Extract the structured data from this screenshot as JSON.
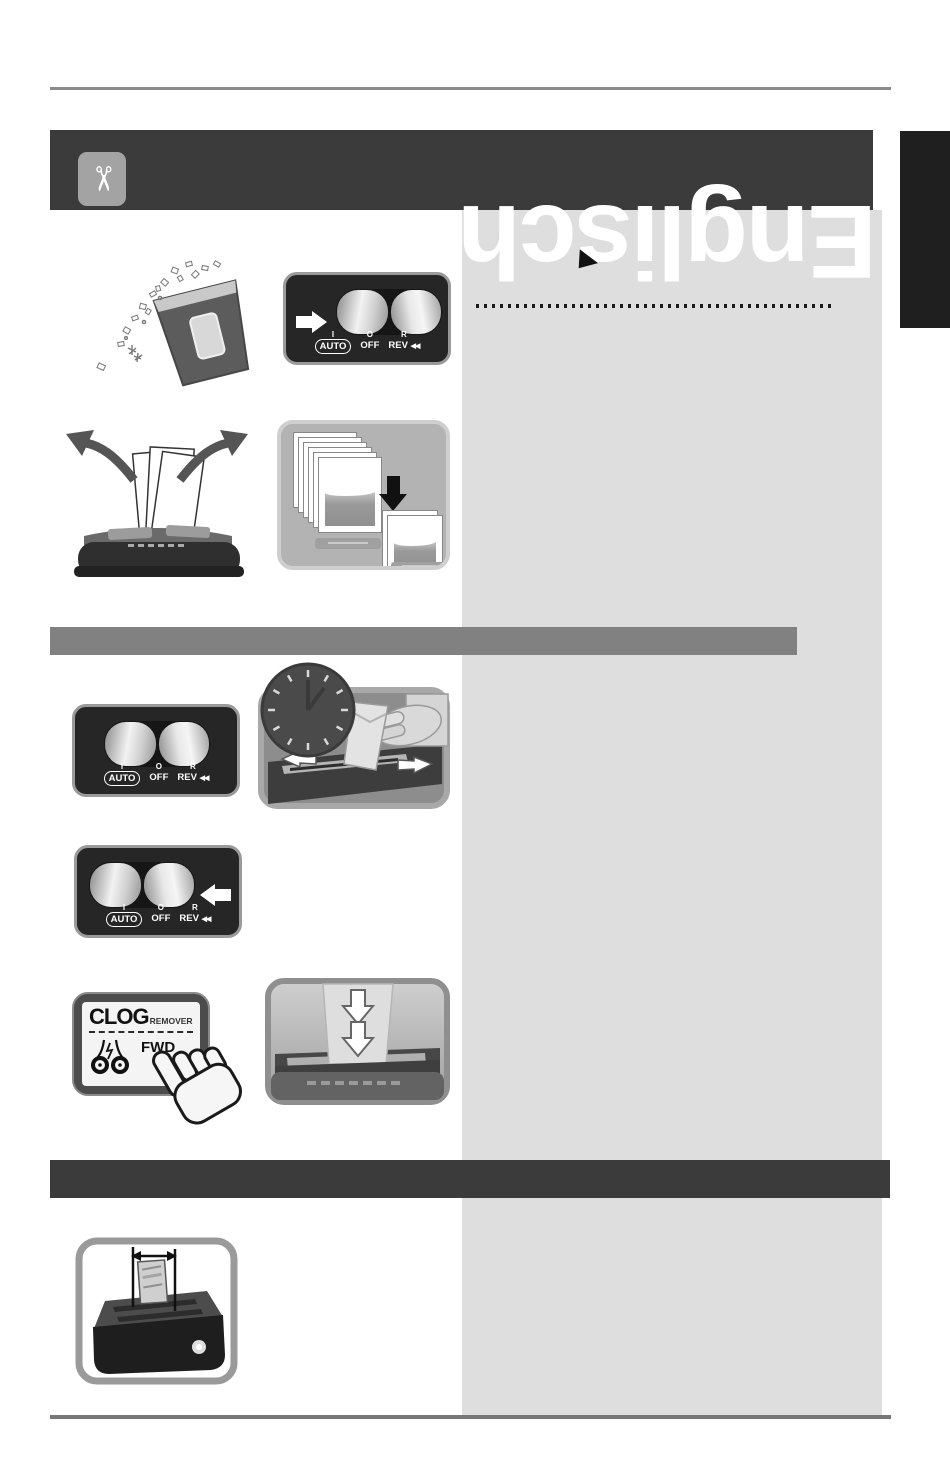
{
  "language_tab": {
    "label": "Englisch"
  },
  "header": {
    "icon_glyph": "✂"
  },
  "rocker": {
    "positions": [
      "I",
      "O",
      "R"
    ],
    "modes": [
      "AUTO",
      "OFF",
      "REV"
    ],
    "rev_arrows": "◀◀"
  },
  "clog_button": {
    "title": "CLOG",
    "subtitle": "REMOVER",
    "action": "FWD",
    "chevrons": "»"
  },
  "colors": {
    "header_bar": "#3b3b3b",
    "content_column": "#dedede",
    "section_divider_gray": "#818181",
    "section_divider_dark": "#3b3b3b",
    "side_tab": "#1f1f1f",
    "rule": "#8a8a8a"
  }
}
